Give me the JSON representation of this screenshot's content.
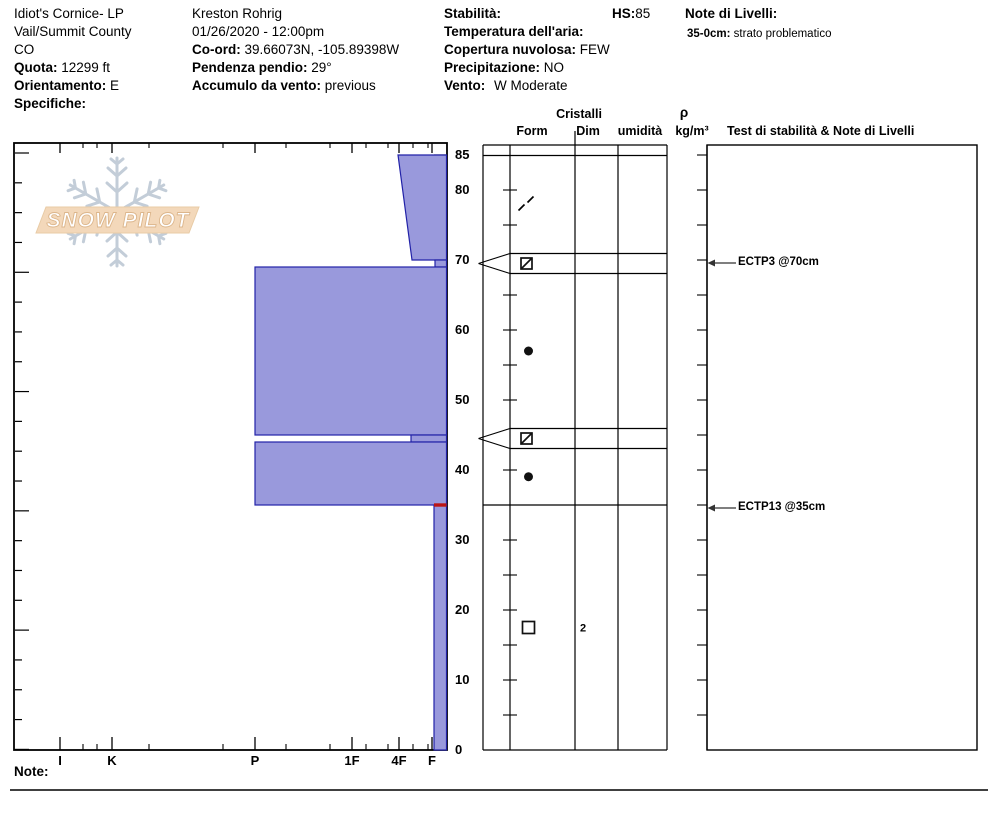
{
  "header": {
    "pit_name": "Idiot's Cornice- LP",
    "region": "Vail/Summit County",
    "state": "CO",
    "quota_label": "Quota:",
    "quota_value": "12299 ft",
    "orientamento_label": "Orientamento:",
    "orientamento_value": "E",
    "specifiche_label": "Specifiche:",
    "observer": "Kreston Rohrig",
    "datetime": "01/26/2020 - 12:00pm",
    "coord_label": "Co-ord:",
    "coord_value": "39.66073N, -105.89398W",
    "pendenza_label": "Pendenza pendio:",
    "pendenza_value": "29°",
    "accumulo_label": "Accumulo da vento:",
    "accumulo_value": "previous",
    "stabilita_label": "Stabilità:",
    "hs_label": "HS:",
    "hs_value": "85",
    "temperatura_label": "Temperatura dell'aria:",
    "copertura_label": "Copertura nuvolosa:",
    "copertura_value": "FEW",
    "precipitazione_label": "Precipitazione:",
    "precipitazione_value": "NO",
    "vento_label": "Vento:",
    "vento_value": "W Moderate",
    "note_livelli_label": "Note di Livelli:",
    "note_range": "35-0cm:",
    "note_text": "strato problematico"
  },
  "logo_text": "SNOW PILOT",
  "table_headers": {
    "cristalli": "Cristalli",
    "form": "Form",
    "dim": "Dim",
    "umidita": "umidità",
    "rho": "ρ",
    "rho_unit": "kg/m³",
    "test": "Test di stabilità & Note di Livelli"
  },
  "note_label": "Note:",
  "chart_data": {
    "type": "snow-profile",
    "title": "Snow pit hardness profile",
    "depth_axis": {
      "unit": "cm",
      "min": 0,
      "max": 85,
      "tick_labels": [
        85,
        80,
        70,
        60,
        50,
        40,
        30,
        20,
        10,
        0
      ]
    },
    "hardness_axis": {
      "tick_labels": [
        "I",
        "K",
        "P",
        "1F",
        "4F",
        "F"
      ],
      "x_px": [
        60,
        112,
        255,
        352,
        399,
        432
      ],
      "minor_x_px": [
        83,
        97,
        149,
        223,
        286,
        330,
        366,
        388,
        413,
        428
      ]
    },
    "layers": [
      {
        "top_cm": 85,
        "bottom_cm": 70,
        "grain": "DF",
        "x_top_px": 398,
        "x_bottom_px": 412
      },
      {
        "top_cm": 70,
        "bottom_cm": 69,
        "grain": "FCxr",
        "x_px": 435,
        "flagged": true
      },
      {
        "top_cm": 69,
        "bottom_cm": 45,
        "grain": "RG",
        "x_px": 255
      },
      {
        "top_cm": 45,
        "bottom_cm": 44,
        "grain": "FCxr",
        "x_px": 411,
        "flagged": true
      },
      {
        "top_cm": 44,
        "bottom_cm": 35,
        "grain": "RG",
        "x_px": 255
      },
      {
        "top_cm": 35,
        "bottom_cm": 0,
        "grain": "FC",
        "dim": "2",
        "x_px": 434,
        "red_top_marker": true
      }
    ],
    "stability_tests": [
      {
        "label": "ECTP3 @70cm",
        "depth_cm": 70
      },
      {
        "label": "ECTP13 @35cm",
        "depth_cm": 35
      }
    ],
    "colors": {
      "layer_fill": "#9999DC",
      "layer_border": "#2222A8",
      "problem_marker": "#BB1414",
      "logo_banner": "#F3D8BA",
      "logo_banner_border": "#E8CBA6",
      "logo_text_stroke": "#DCB68C",
      "snowflake": "#C3CDD8"
    }
  }
}
